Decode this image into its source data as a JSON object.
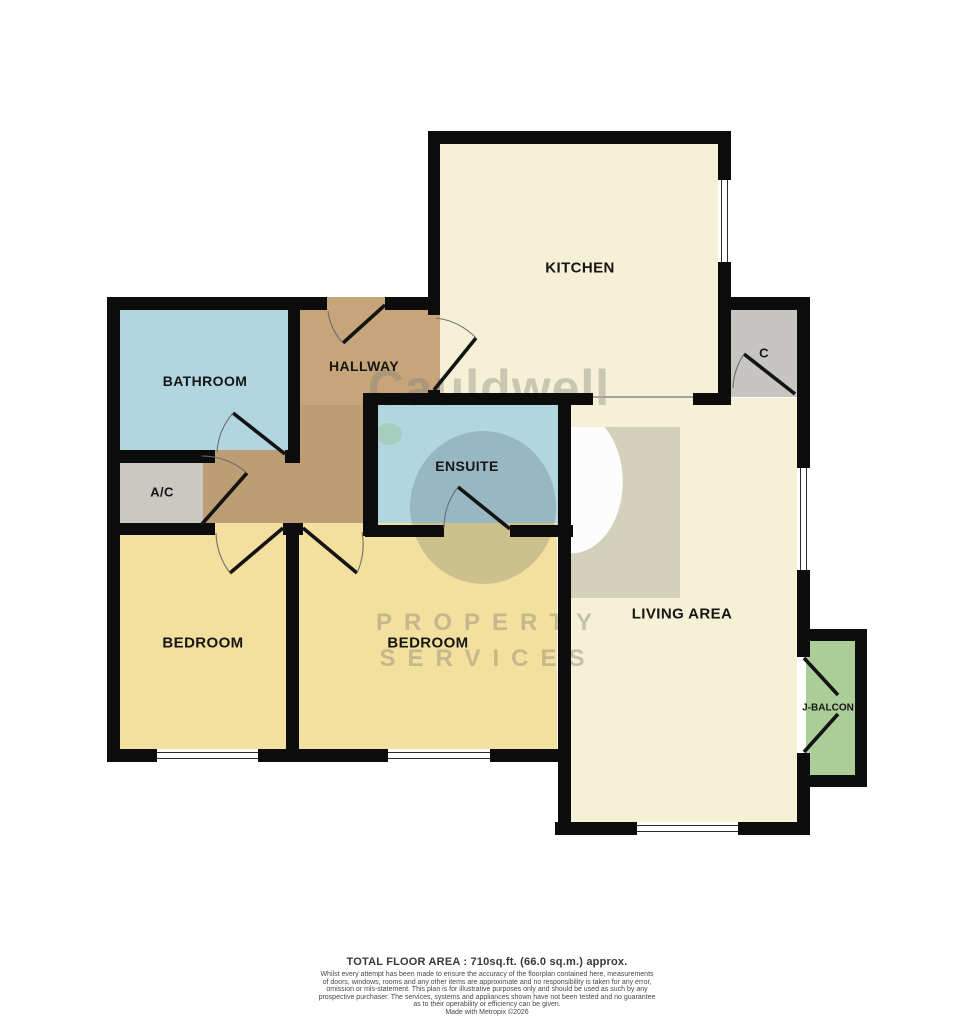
{
  "plan": {
    "title": "Floorplan",
    "colors": {
      "wall": "#0c0c0c",
      "kitchen_living_cream": "#f6f0d6",
      "bedroom_yellow": "#f4e09e",
      "bath_blue": "#b2d6e0",
      "hallway_tan": "#c6a57a",
      "hallway_tan_dark": "#bc9d74",
      "cupboard_gray": "#cbc7c3",
      "closet_gray": "#c6c5c1",
      "balcony_green": "#abce98",
      "window_white": "#ffffff"
    },
    "rooms": {
      "kitchen": {
        "label": "KITCHEN"
      },
      "bathroom": {
        "label": "BATHROOM"
      },
      "hallway": {
        "label": "HALLWAY"
      },
      "ac": {
        "label": "A/C"
      },
      "ensuite": {
        "label": "ENSUITE"
      },
      "bedroom1": {
        "label": "BEDROOM"
      },
      "bedroom2": {
        "label": "BEDROOM"
      },
      "living": {
        "label": "LIVING AREA"
      },
      "closet": {
        "label": "C"
      },
      "balcony": {
        "label": "J-BALCON"
      }
    }
  },
  "watermark": {
    "brand": "Cauldwell",
    "word1": "PROPERTY",
    "word2": "SERVICES"
  },
  "footer": {
    "total_area": "TOTAL FLOOR AREA : 710sq.ft. (66.0 sq.m.) approx.",
    "disclaimer": [
      "Whilst every attempt has been made to ensure the accuracy of the floorplan contained here, measurements",
      "of doors, windows, rooms and any other items are approximate and no responsibility is taken for any error,",
      "omission or mis-statement. This plan is for illustrative purposes only and should be used as such by any",
      "prospective purchaser. The services, systems and appliances shown have not been tested and no guarantee",
      "as to their operability or efficiency can be given.",
      "Made with Metropix ©2026"
    ]
  }
}
